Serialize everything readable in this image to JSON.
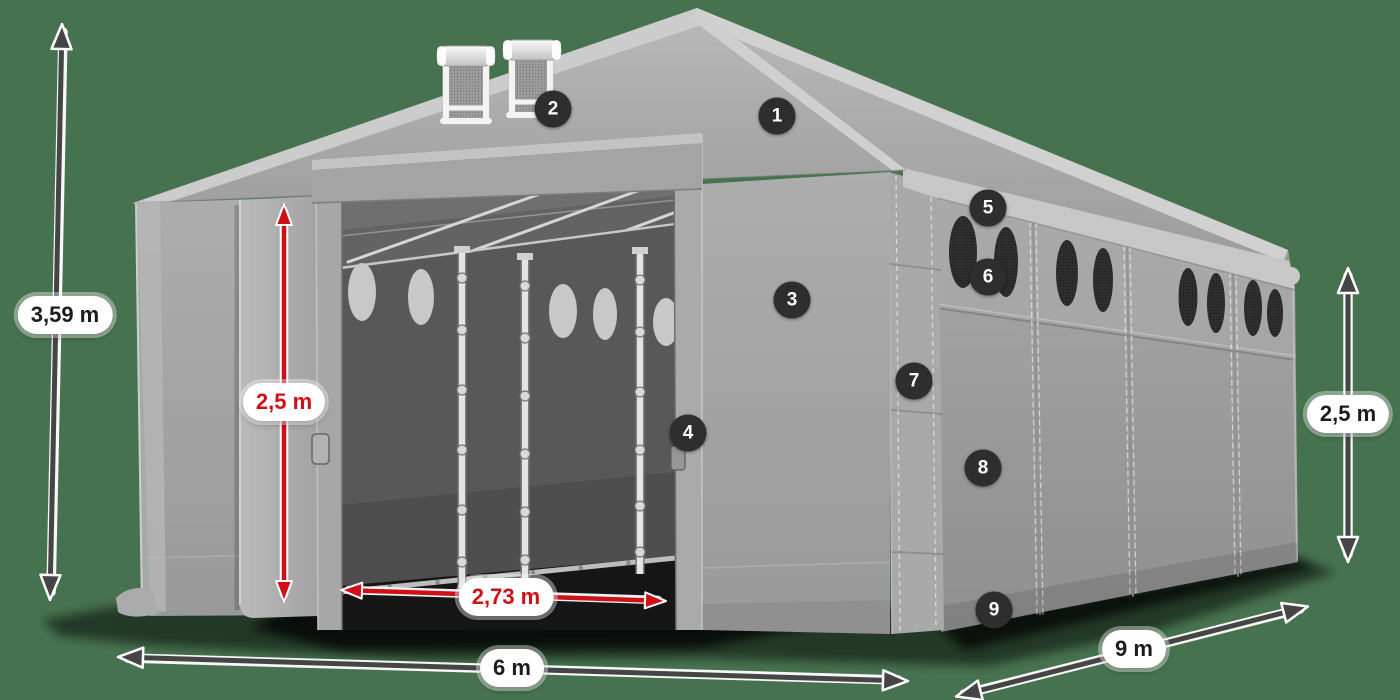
{
  "dimensions": {
    "total_height": "3,59 m",
    "door_height": "2,5 m",
    "door_width": "2,73 m",
    "front_width": "6 m",
    "side_length": "9 m",
    "side_height": "2,5 m"
  },
  "markers": [
    {
      "number": "1"
    },
    {
      "number": "2"
    },
    {
      "number": "3"
    },
    {
      "number": "4"
    },
    {
      "number": "5"
    },
    {
      "number": "6"
    },
    {
      "number": "7"
    },
    {
      "number": "8"
    },
    {
      "number": "9"
    }
  ],
  "colors": {
    "background": "#47724f",
    "dimension_red": "#cf1016",
    "dimension_gray": "#454545",
    "marker_bg": "#2e2e2e",
    "marker_text": "#ffffff",
    "pill_bg": "#ffffff",
    "pill_text": "#1c1c1c"
  }
}
